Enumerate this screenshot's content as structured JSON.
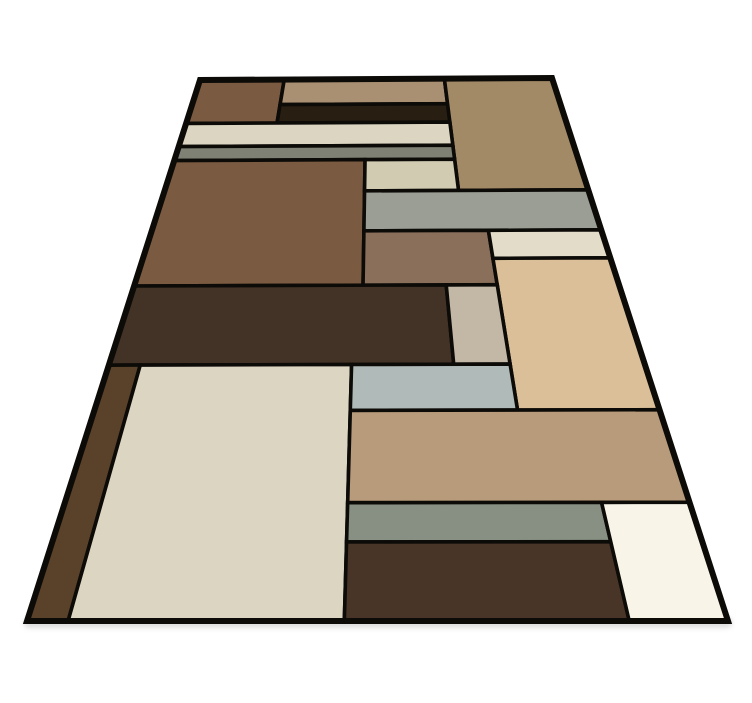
{
  "image": {
    "description": "Geometric color-block area rug shown in floor perspective on a plain white background",
    "background_color": "#ffffff",
    "width": 752,
    "height": 703
  },
  "shadow": {
    "color": "#c2c2c2",
    "opacity": 0.55,
    "x": 24,
    "y": 617,
    "width": 708,
    "height": 11,
    "blur": 2.5
  },
  "rug": {
    "border_color": "#0d0b08",
    "inner_line_width": 3.6,
    "outer_line_width": 6,
    "corners": {
      "top_left": [
        200,
        80
      ],
      "top_right": [
        552,
        78
      ],
      "bottom_right": [
        728,
        621
      ],
      "bottom_left": [
        27,
        621
      ]
    },
    "patches": [
      {
        "name": "top-left-brown-block",
        "color": "#7a5a40",
        "u": [
          0,
          0.24
        ],
        "v": [
          0,
          0.148
        ]
      },
      {
        "name": "top-middle-tan-block",
        "color": "#aa9072",
        "u": [
          0.24,
          0.695
        ],
        "v": [
          0,
          0.088
        ]
      },
      {
        "name": "dark-inset-strip",
        "color": "#281e12",
        "u": [
          0.24,
          0.695
        ],
        "v": [
          0.088,
          0.148
        ]
      },
      {
        "name": "top-right-tan-block",
        "color": "#a38a66",
        "u": [
          0.695,
          1
        ],
        "v": [
          0,
          0.341
        ]
      },
      {
        "name": "cream-stripe",
        "color": "#dbd5c1",
        "u": [
          0,
          0.695
        ],
        "v": [
          0.148,
          0.218
        ]
      },
      {
        "name": "olive-gray-stripe",
        "color": "#7e8174",
        "u": [
          0,
          0.695
        ],
        "v": [
          0.218,
          0.258
        ]
      },
      {
        "name": "left-brown-block",
        "color": "#7a5b41",
        "u": [
          0,
          0.4735
        ],
        "v": [
          0.258,
          0.55
        ]
      },
      {
        "name": "beige-block",
        "color": "#d1cbb2",
        "u": [
          0.4735,
          0.695
        ],
        "v": [
          0.258,
          0.341
        ]
      },
      {
        "name": "wide-gray-band",
        "color": "#9a9e94",
        "u": [
          0.4735,
          1
        ],
        "v": [
          0.341,
          0.4365
        ]
      },
      {
        "name": "mauve-brown-block",
        "color": "#8a6f5b",
        "u": [
          0.4735,
          0.75
        ],
        "v": [
          0.4365,
          0.55
        ]
      },
      {
        "name": "right-cream-strip",
        "color": "#e2dcc8",
        "u": [
          0.75,
          1
        ],
        "v": [
          0.4365,
          0.497
        ]
      },
      {
        "name": "right-beige-column",
        "color": "#dabf98",
        "u": [
          0.75,
          1
        ],
        "v": [
          0.497,
          0.758
        ]
      },
      {
        "name": "espresso-band",
        "color": "#433327",
        "u": [
          0,
          0.645
        ],
        "v": [
          0.55,
          0.689
        ]
      },
      {
        "name": "taupe-block",
        "color": "#c3b7a6",
        "u": [
          0.645,
          0.75
        ],
        "v": [
          0.55,
          0.689
        ]
      },
      {
        "name": "left-edge-sliver",
        "color": "#5a4129",
        "u": [
          0,
          0.059
        ],
        "v": [
          0.689,
          1
        ]
      },
      {
        "name": "cream-field",
        "color": "#dcd5c1",
        "u": [
          0.059,
          0.4545
        ],
        "v": [
          0.689,
          1
        ]
      },
      {
        "name": "bluegray-stripe",
        "color": "#b0bbb9",
        "u": [
          0.4545,
          0.75
        ],
        "v": [
          0.689,
          0.758
        ]
      },
      {
        "name": "tan-band",
        "color": "#b79b7a",
        "u": [
          0.4545,
          1
        ],
        "v": [
          0.758,
          0.877
        ]
      },
      {
        "name": "sage-stripe",
        "color": "#879082",
        "u": [
          0.4545,
          0.86
        ],
        "v": [
          0.877,
          0.921
        ]
      },
      {
        "name": "bottom-brown-block",
        "color": "#493527",
        "u": [
          0.4545,
          0.86
        ],
        "v": [
          0.921,
          1
        ]
      },
      {
        "name": "ivory-block",
        "color": "#f8f5e8",
        "u": [
          0.86,
          1
        ],
        "v": [
          0.877,
          1
        ]
      }
    ]
  }
}
